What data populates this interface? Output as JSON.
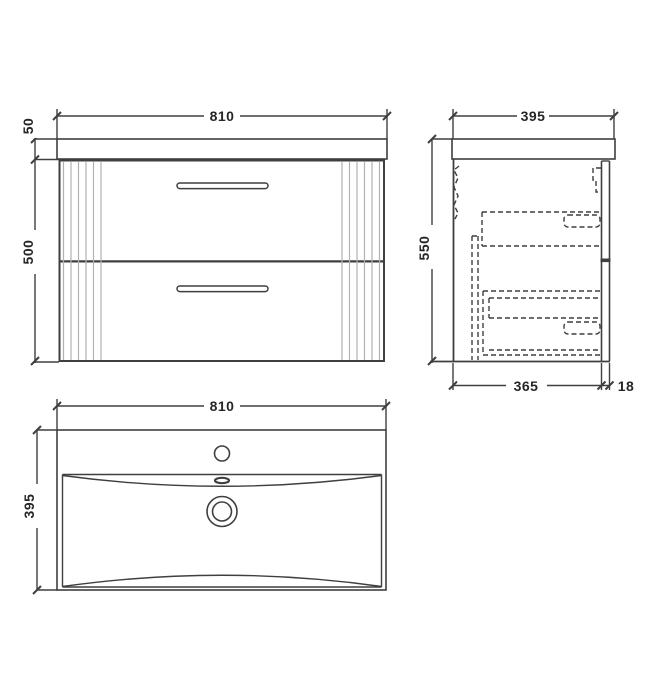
{
  "colors": {
    "line": "#3f3f3f",
    "flute": "#b2b2b2",
    "text": "#262626",
    "background": "#ffffff"
  },
  "front_view": {
    "width_label": "810",
    "worktop_height_label": "50",
    "cabinet_height_label": "500"
  },
  "side_view": {
    "depth_label": "395",
    "height_label": "550",
    "carcass_depth_label": "365",
    "front_panel_thickness_label": "18"
  },
  "plan_view": {
    "width_label": "810",
    "depth_label": "395"
  }
}
